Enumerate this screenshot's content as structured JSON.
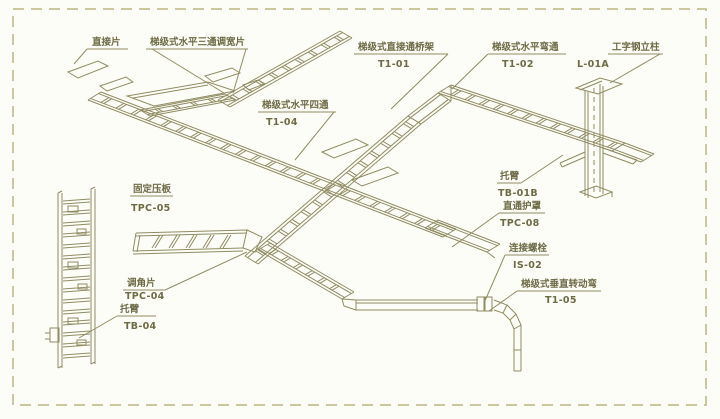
{
  "diagram": {
    "description": "Isometric installation drawing of ladder-type cable tray (bridge) system with part callouts",
    "colors": {
      "line": "#8f8c63",
      "text": "#6e6b47",
      "border": "#cac89c",
      "background": "#fdfdf7"
    }
  },
  "callouts": [
    {
      "id": "straight-connector-plate",
      "name": "直接片",
      "code": ""
    },
    {
      "id": "tee-width-adjust-plate",
      "name": "梯级式水平三通调宽片",
      "code": ""
    },
    {
      "id": "straight-through-bridge",
      "name": "梯级式直接通桥架",
      "code": "T1-01"
    },
    {
      "id": "horizontal-bend",
      "name": "梯级式水平弯通",
      "code": "T1-02"
    },
    {
      "id": "i-beam-column",
      "name": "工字钢立柱",
      "code": "L-01A"
    },
    {
      "id": "horizontal-cross",
      "name": "梯级式水平四通",
      "code": "T1-04"
    },
    {
      "id": "fixing-pressure-plate",
      "name": "固定压板",
      "code": "TPC-05"
    },
    {
      "id": "support-arm-b",
      "name": "托臂",
      "code": "TB-01B"
    },
    {
      "id": "straight-cover",
      "name": "直通护罩",
      "code": "TPC-08"
    },
    {
      "id": "connecting-bolt",
      "name": "连接螺栓",
      "code": "IS-02"
    },
    {
      "id": "vertical-rotating-bend",
      "name": "梯级式垂直转动弯",
      "code": "T1-05"
    },
    {
      "id": "angle-adjust-plate",
      "name": "调角片",
      "code": "TPC-04"
    },
    {
      "id": "support-arm-4",
      "name": "托臂",
      "code": "TB-04"
    }
  ]
}
